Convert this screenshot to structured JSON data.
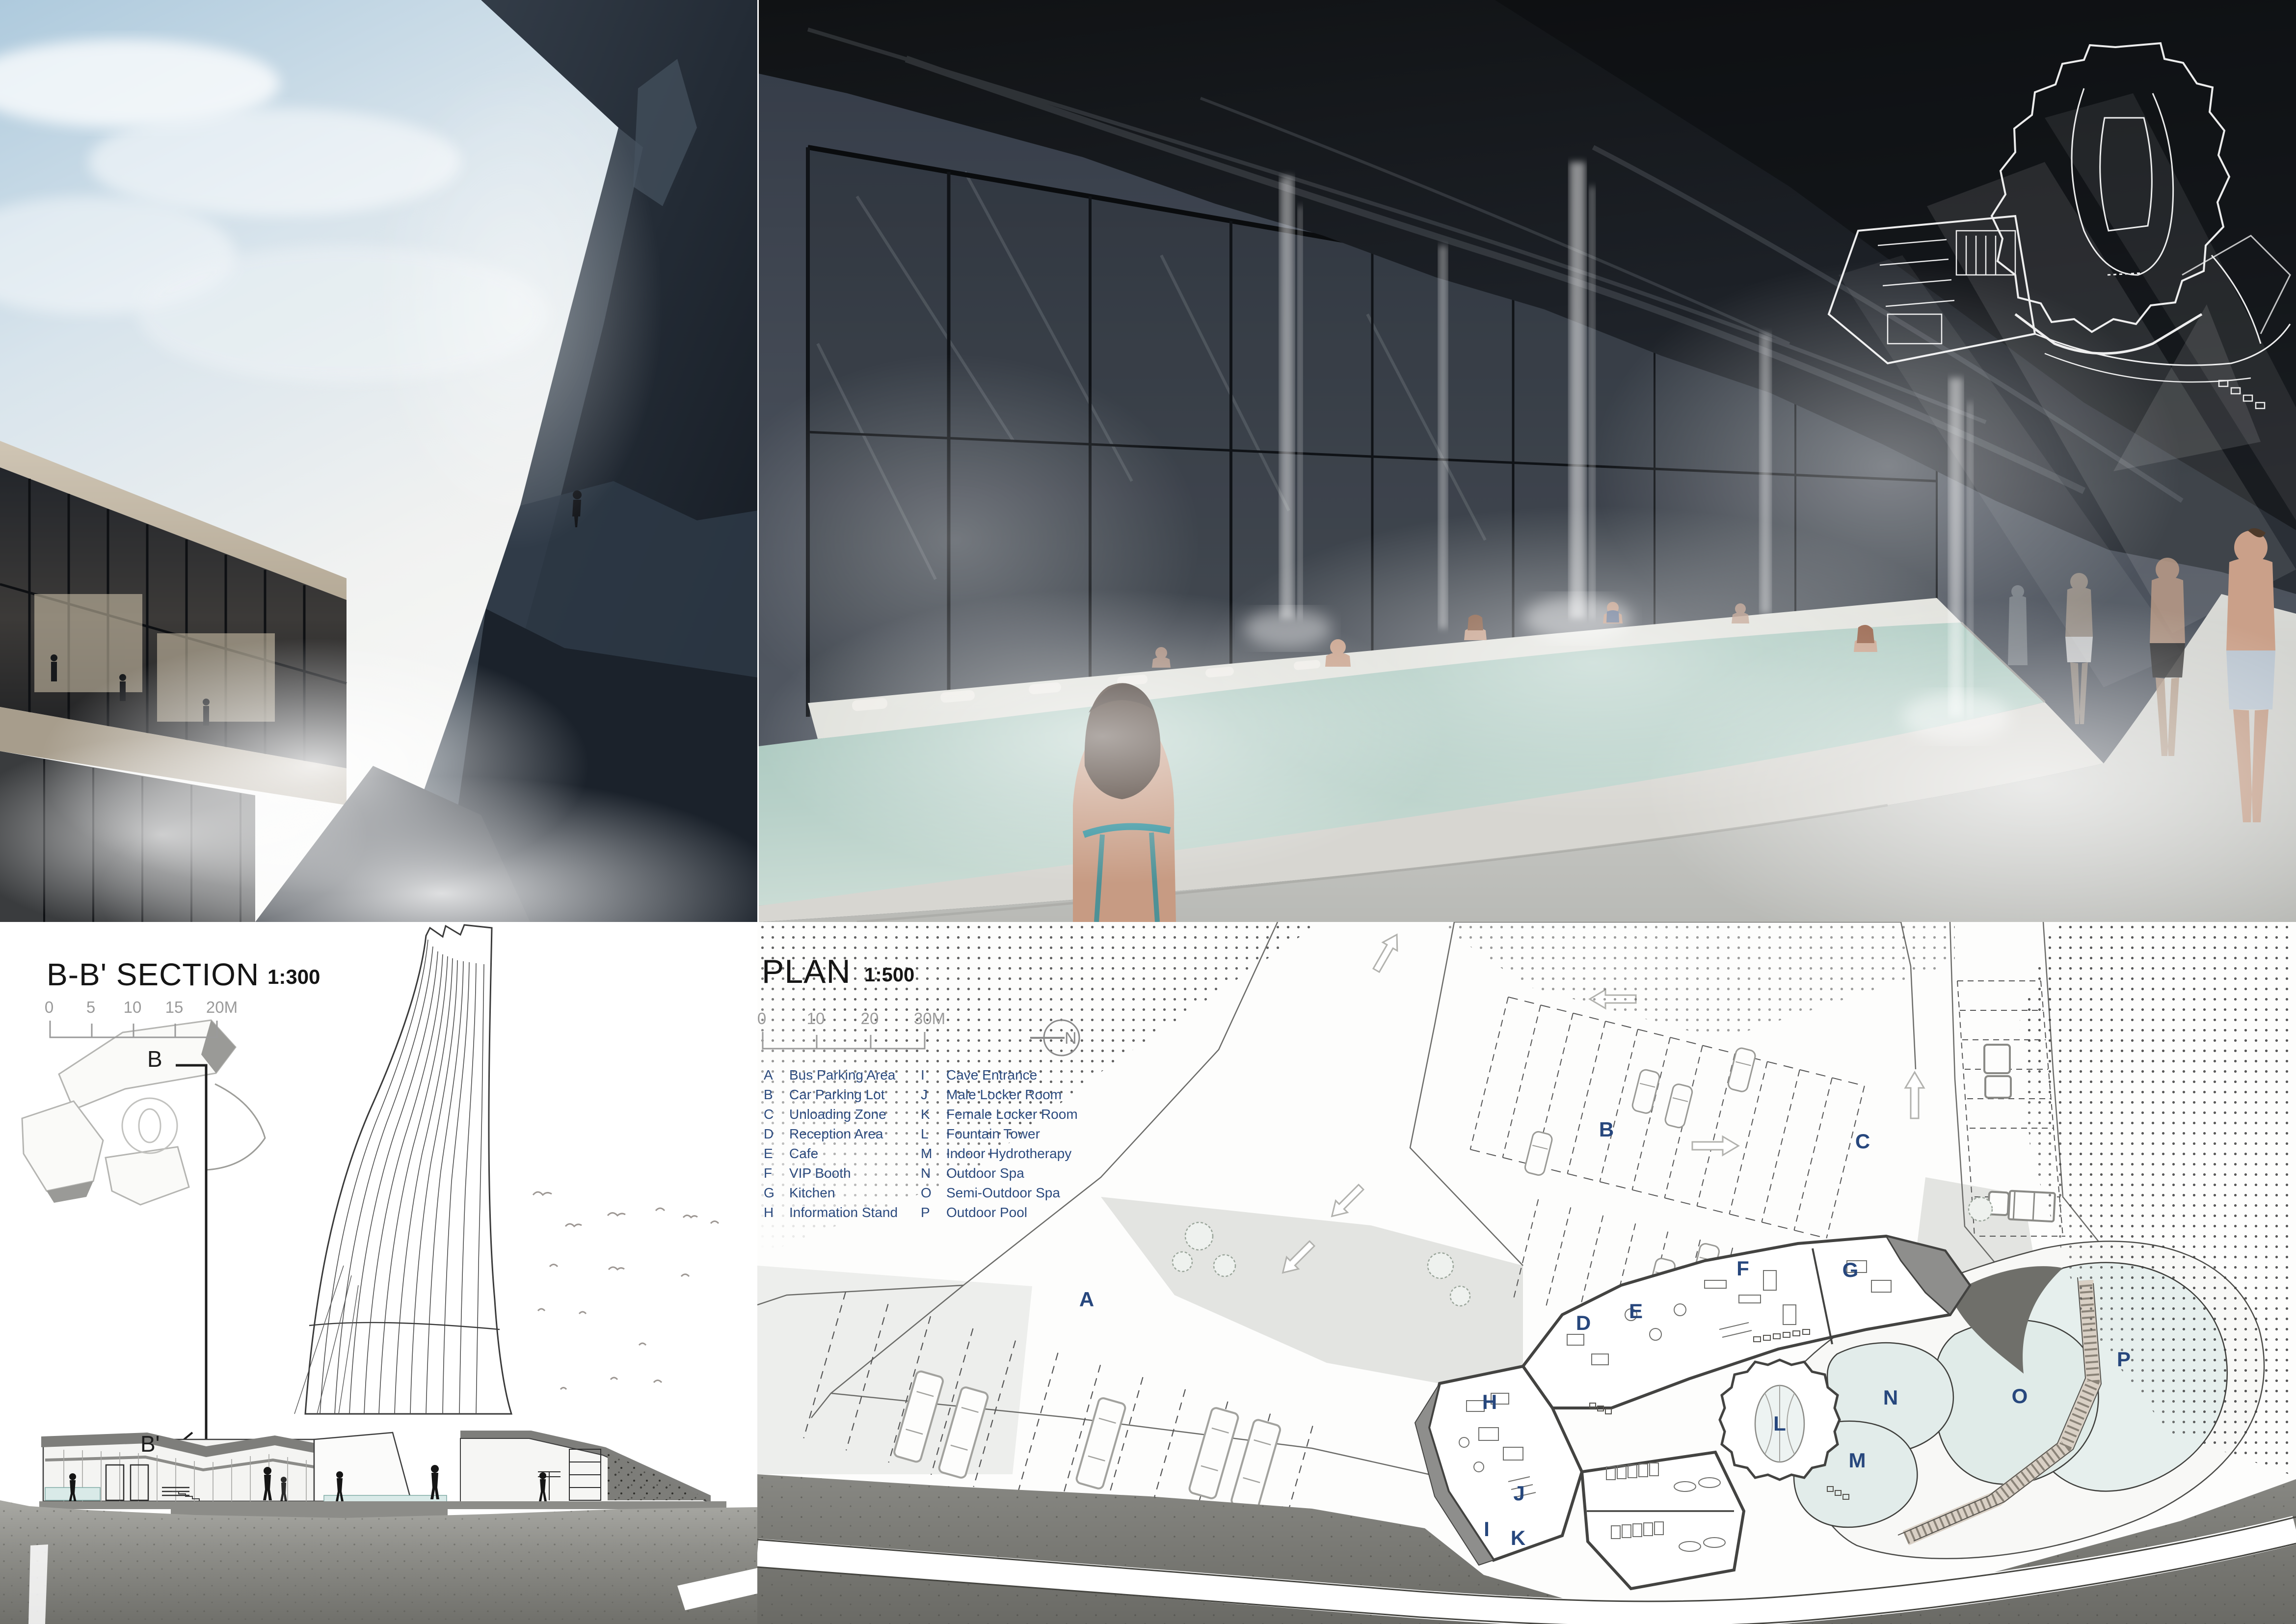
{
  "board": {
    "type": "architecture-presentation-board",
    "subject": "cliff-canyon hot spring spa resort"
  },
  "section": {
    "title": "B-B' SECTION",
    "scale": "1:300",
    "scale_ticks": [
      "0",
      "5",
      "10",
      "15",
      "20M"
    ],
    "key_plan": {
      "cut_start_label": "B",
      "cut_end_label": "B'"
    }
  },
  "plan": {
    "title": "PLAN",
    "scale": "1:500",
    "scale_ticks": [
      "0",
      "10",
      "20",
      "30M"
    ],
    "north_label": "N",
    "legend": [
      {
        "key": "A",
        "label": "Bus Parking Area"
      },
      {
        "key": "B",
        "label": "Car Parking Lot"
      },
      {
        "key": "C",
        "label": "Unloading Zone"
      },
      {
        "key": "D",
        "label": "Reception Area"
      },
      {
        "key": "E",
        "label": "Cafe"
      },
      {
        "key": "F",
        "label": "VIP Booth"
      },
      {
        "key": "G",
        "label": "Kitchen"
      },
      {
        "key": "H",
        "label": "Information Stand"
      },
      {
        "key": "I",
        "label": "Cave Entrance"
      },
      {
        "key": "J",
        "label": "Male Locker Room"
      },
      {
        "key": "K",
        "label": "Female Locker Room"
      },
      {
        "key": "L",
        "label": "Fountain Tower"
      },
      {
        "key": "M",
        "label": "Indoor Hydrotherapy"
      },
      {
        "key": "N",
        "label": "Outdoor Spa"
      },
      {
        "key": "O",
        "label": "Semi-Outdoor Spa"
      },
      {
        "key": "P",
        "label": "Outdoor Pool"
      }
    ],
    "area_labels": [
      "A",
      "B",
      "C",
      "D",
      "E",
      "F",
      "G",
      "H",
      "I",
      "J",
      "K",
      "L",
      "M",
      "N",
      "O",
      "P"
    ]
  },
  "colors": {
    "label_blue": "#27477d",
    "scale_gray": "#9a9a9a",
    "plan_wall": "#4b4b4b",
    "roof_shade": "#8e8e8c",
    "pool_water_plan": "#e2ecea",
    "boardwalk_tan": "#d9d0c5",
    "cliff_gray": "#7b7b76",
    "pool_water_render": "#a9c8bd",
    "cave_rock": "#1a1d21",
    "sky_blue": "#bdd2e2"
  }
}
